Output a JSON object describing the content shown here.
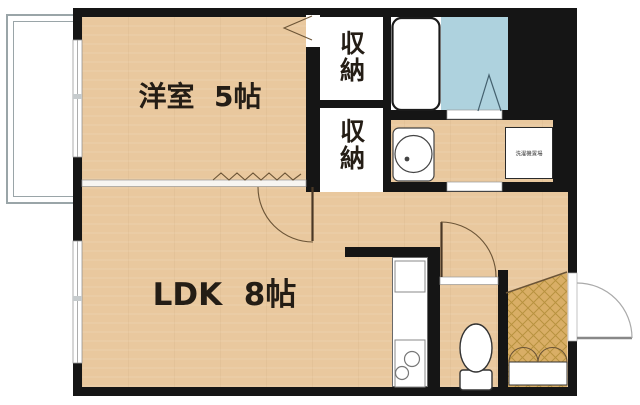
{
  "plan": {
    "type": "apartment-floor-plan",
    "rooms": {
      "western_room": {
        "label": "洋室  5帖"
      },
      "ldk": {
        "label": "LDK  8帖"
      },
      "closet_upper": {
        "label": "収納"
      },
      "closet_lower": {
        "label": "収納"
      },
      "laundry_space": {
        "label": "洗濯機置場"
      }
    },
    "fixtures": [
      "bathtub-icon",
      "bathroom-folding-door-icon",
      "washbasin-icon",
      "kitchen-sink-icon",
      "stove-burners-icon",
      "toilet-icon",
      "shoe-cabinet-icon",
      "entrance-tile",
      "balcony",
      "window",
      "door-swing-arc",
      "accordion-partition"
    ],
    "colors": {
      "wall": "#151515",
      "wood_floor": "#e9c89e",
      "bathroom_floor": "#aed2de",
      "entrance_tile": "#d9ae66",
      "tile_hatch": "#b8923f",
      "balcony_outline": "#9aa5a8",
      "door_swing": "#6b5436",
      "text": "#241d15"
    }
  }
}
